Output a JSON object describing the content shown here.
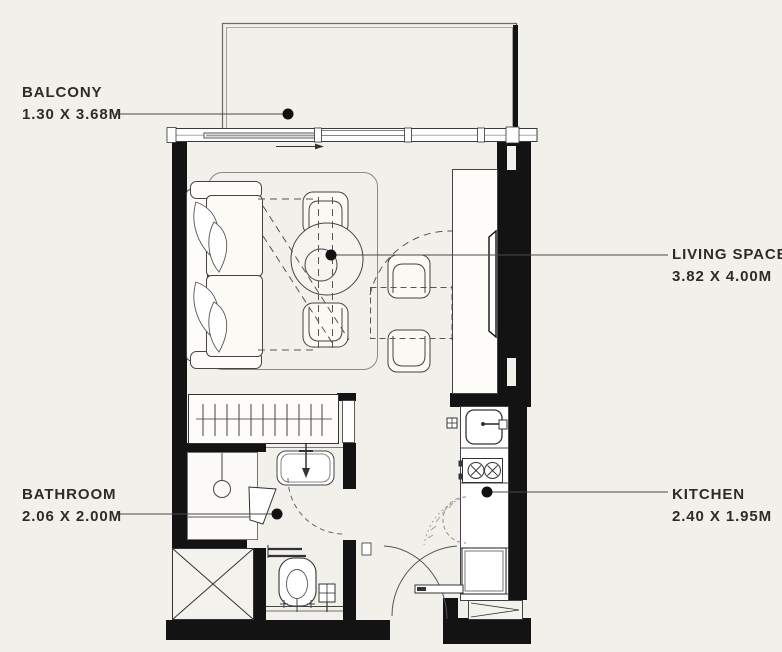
{
  "colors": {
    "background": "#f2f0ea",
    "walls": "#131313",
    "lines": "#4a4a4a",
    "text": "#2e2c29"
  },
  "labels": {
    "balcony": {
      "name": "BALCONY",
      "dimensions": "1.30 X 3.68M"
    },
    "living_space": {
      "name": "LIVING SPACE",
      "dimensions": "3.82 X 4.00M"
    },
    "bathroom": {
      "name": "BATHROOM",
      "dimensions": "2.06 X 2.00M"
    },
    "kitchen": {
      "name": "KITCHEN",
      "dimensions": "2.40 X 1.95M"
    }
  },
  "furniture_icons": [
    "sofa-icon",
    "rug-icon",
    "coffee-table-icon",
    "armchair-icon",
    "dining-chair-icon",
    "dining-table-icon",
    "tv-console-icon",
    "tv-icon",
    "wardrobe-icon",
    "shower-icon",
    "washbasin-icon",
    "toilet-icon",
    "service-shaft-icon",
    "kitchen-sink-icon",
    "hob-icon",
    "refrigerator-icon",
    "entry-door-icon",
    "sliding-balcony-door-icon"
  ]
}
